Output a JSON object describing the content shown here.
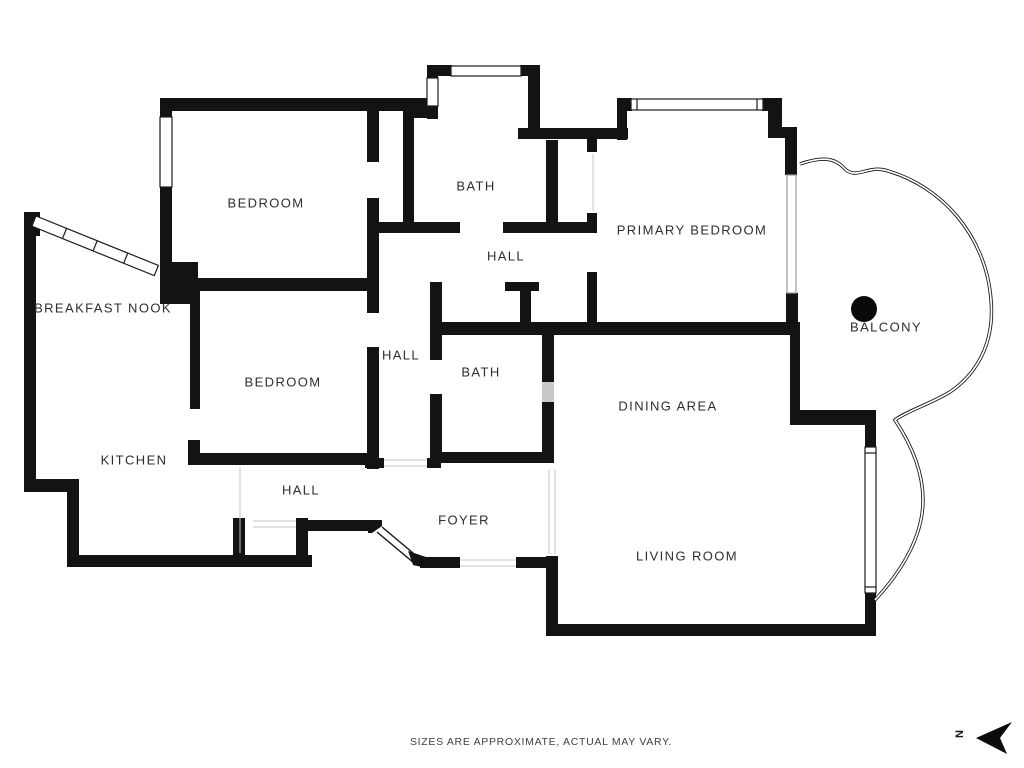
{
  "plan": {
    "rooms": {
      "bedroom1": "BEDROOM",
      "bath1": "BATH",
      "hall_upper": "HALL",
      "primary_bedroom": "PRIMARY BEDROOM",
      "breakfast_nook": "BREAKFAST NOOK",
      "bedroom2": "BEDROOM",
      "hall_center": "HALL",
      "bath2": "BATH",
      "dining_area": "DINING AREA",
      "balcony": "BALCONY",
      "kitchen": "KITCHEN",
      "hall_lower": "HALL",
      "foyer": "FOYER",
      "living_room": "LIVING ROOM"
    },
    "compass": {
      "north_label": "N"
    },
    "footer": {
      "disclaimer": "SIZES ARE APPROXIMATE, ACTUAL MAY VARY."
    },
    "colors": {
      "wall": "#131313",
      "label_text": "#2e2e2e",
      "footer_text": "#3f3f3f",
      "thin_line": "#c4c4c4",
      "door_panel": "#c9c9c9",
      "background": "#ffffff"
    }
  }
}
